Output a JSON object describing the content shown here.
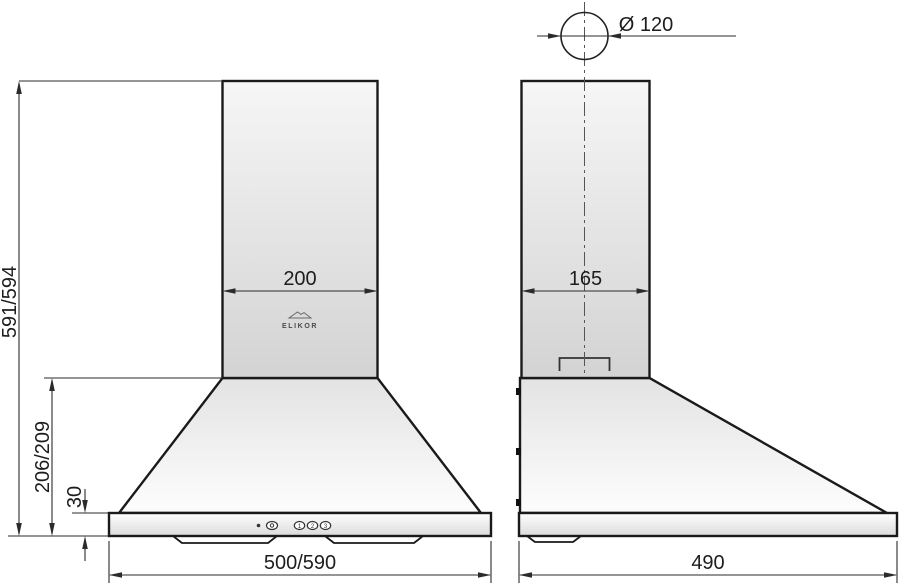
{
  "title": "Kitchen hood dimensional drawing",
  "brand": {
    "logo_text": "ELIKOR"
  },
  "front_view": {
    "duct_width": "200",
    "total_height": "591/594",
    "cone_height": "206/209",
    "base_height": "30",
    "bottom_width": "500/590"
  },
  "side_view": {
    "duct_depth": "165",
    "bottom_depth": "490",
    "outlet_diameter": "Ø 120"
  },
  "controls": {
    "speed_buttons": [
      "1",
      "2",
      "3"
    ]
  },
  "colors": {
    "outline": "#1a1a1a",
    "dimension_line": "#2b2b2b",
    "fill_light": "#fbfbfb",
    "fill_dark": "#d5d5d5"
  }
}
